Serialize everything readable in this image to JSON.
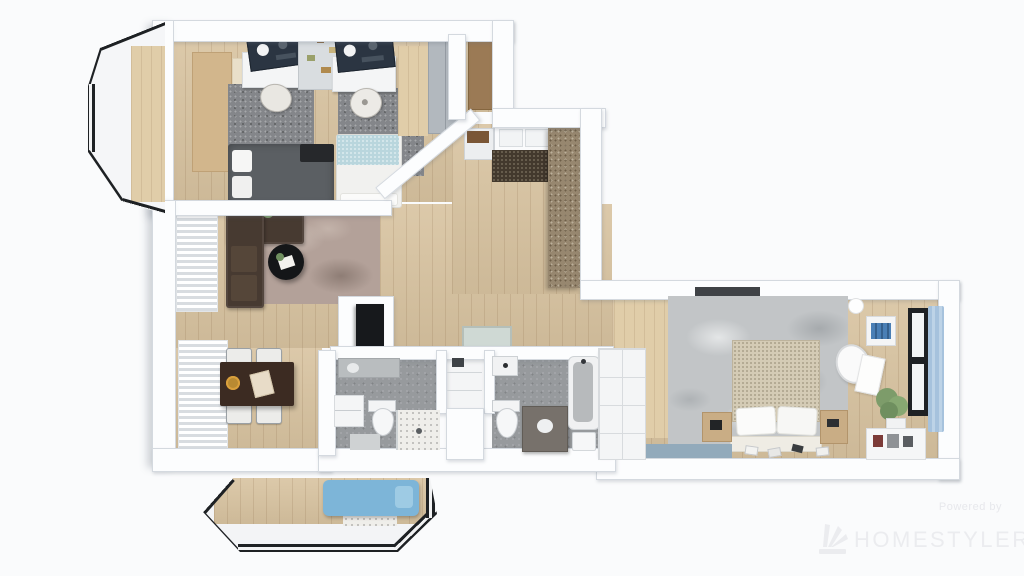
{
  "watermark": {
    "powered_by": "Powered by",
    "brand": "HOMESTYLER",
    "logo_icon": "homestyler-fan-icon"
  },
  "scene": {
    "type": "3d-floorplan-top-view-render",
    "rooms": [
      "kids-bedroom-study",
      "entry-hall",
      "living-room",
      "dining-area",
      "bathroom-left",
      "storage-niche",
      "bathroom-right",
      "master-bedroom",
      "balcony",
      "bay-window"
    ]
  },
  "palette": {
    "bg": "#fafbfc",
    "wall": "#fcfdfe",
    "wallEdge": "#d4d9df",
    "wood": "#d8c3a0",
    "carpetDark": "#84868a",
    "rugCream": "#e9dfc9",
    "rugMauve": "#b3a199",
    "rugTeal": "#b9d6dd",
    "rugBlue": "#92aabb",
    "marble": "#c2c5c7",
    "bedDark": "#5b5f63",
    "bedBeige": "#d4cbb5",
    "sofaBrown": "#473a31",
    "tableBrown": "#3c2b22",
    "doormat": "#43392d",
    "closetBrown": "#97876f",
    "concrete": "#979a9d",
    "frameBlack": "#1e2124",
    "glass": "#f2f4f5",
    "curtainBlue": "#a6c2dd",
    "loungeBlue": "#7db5d8",
    "gold": "#b98a32",
    "plantGreen": "#7d9c6a",
    "wmText": "#e7e8ec",
    "wmBrand": "#ebecef"
  }
}
